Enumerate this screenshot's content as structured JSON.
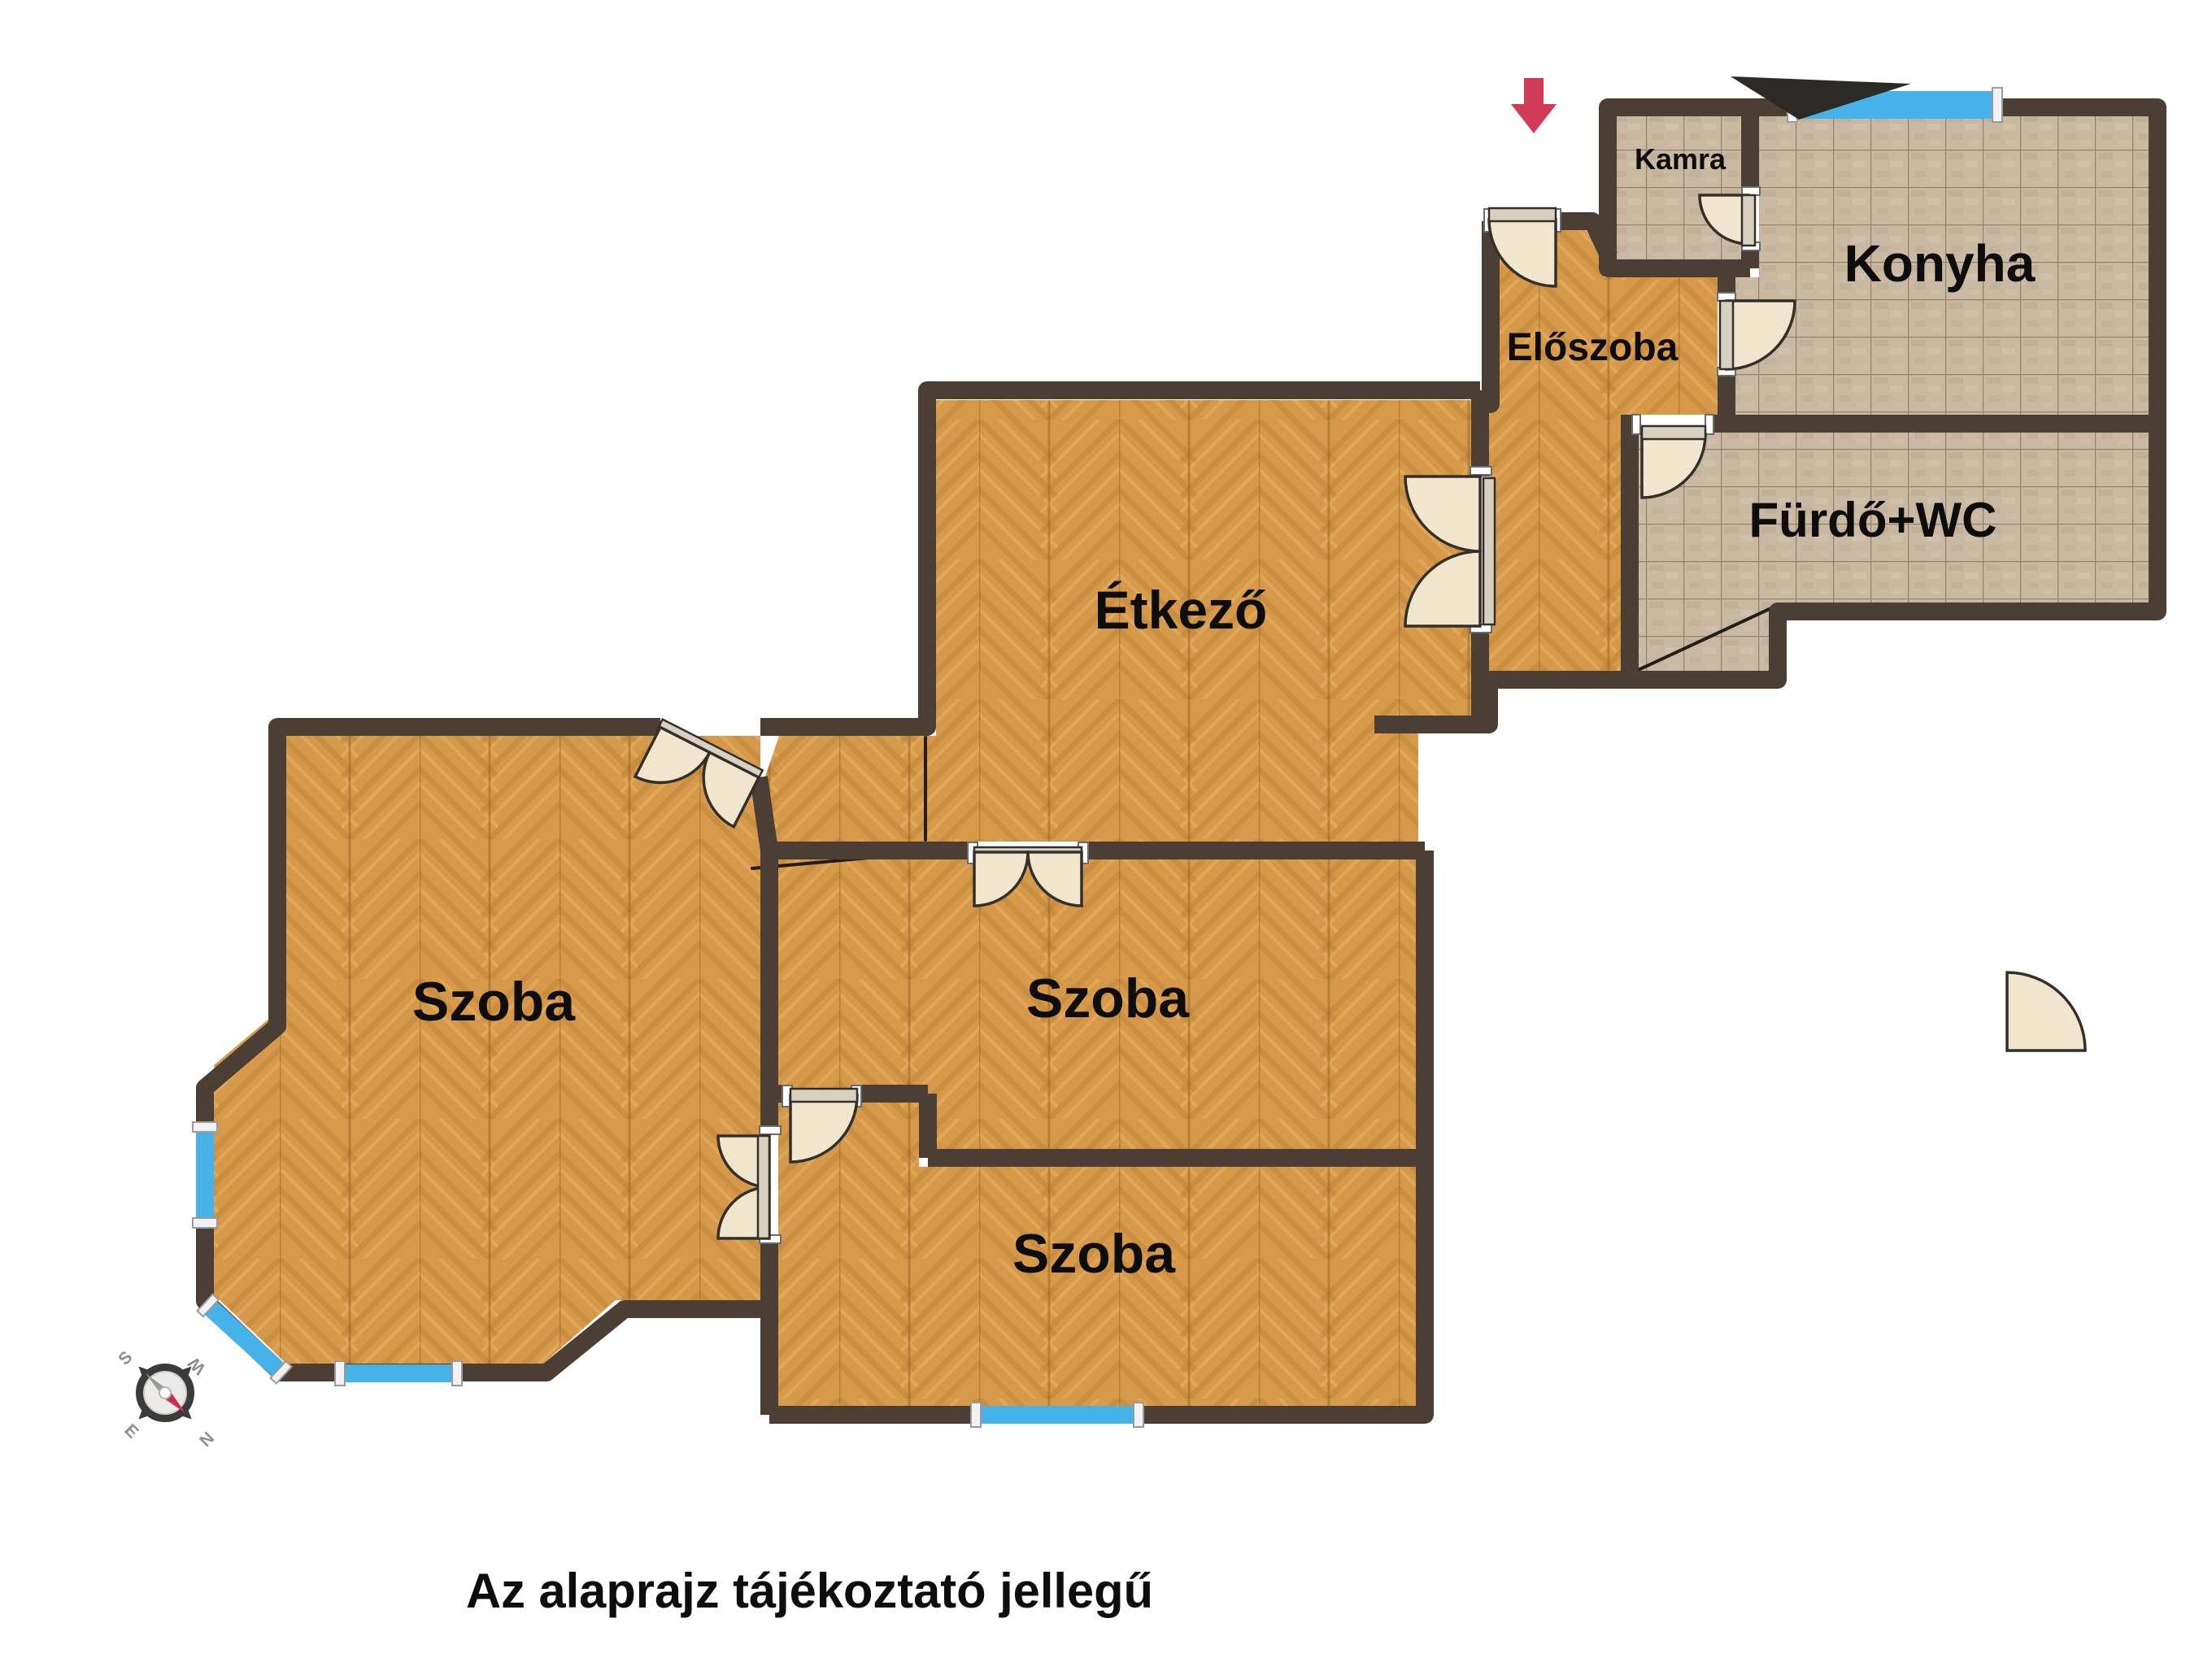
{
  "plan": {
    "type": "apartment-floor-plan",
    "language": "hu",
    "rooms": [
      {
        "id": "kamra",
        "label": "Kamra",
        "floor": "tile"
      },
      {
        "id": "konyha",
        "label": "Konyha",
        "floor": "tile"
      },
      {
        "id": "eloszoba",
        "label": "Előszoba",
        "floor": "wood"
      },
      {
        "id": "furdo-wc",
        "label": "Fürdő+WC",
        "floor": "tile"
      },
      {
        "id": "etkezo",
        "label": "Étkező",
        "floor": "wood"
      },
      {
        "id": "szoba-left",
        "label": "Szoba",
        "floor": "wood"
      },
      {
        "id": "szoba-middle",
        "label": "Szoba",
        "floor": "wood"
      },
      {
        "id": "szoba-bottom",
        "label": "Szoba",
        "floor": "wood"
      }
    ],
    "note": {
      "text": "Az alaprajz tájékoztató jellegű"
    },
    "compass": {
      "letters": {
        "n": "N",
        "s": "S",
        "e": "E",
        "w": "W"
      }
    },
    "entrance_marker": "down-arrow"
  },
  "colors": {
    "wall": "#4a3e35",
    "wood": "#d69949",
    "wood_dark": "#bd8136",
    "wood_light": "#e7b166",
    "tile": "#c9b8a2",
    "grout": "#93826d",
    "door": "#f1e5cd",
    "window": "#45b2e8",
    "arrow": "#d23b55",
    "text": "#0d0d0d",
    "background": "#ffffff"
  }
}
